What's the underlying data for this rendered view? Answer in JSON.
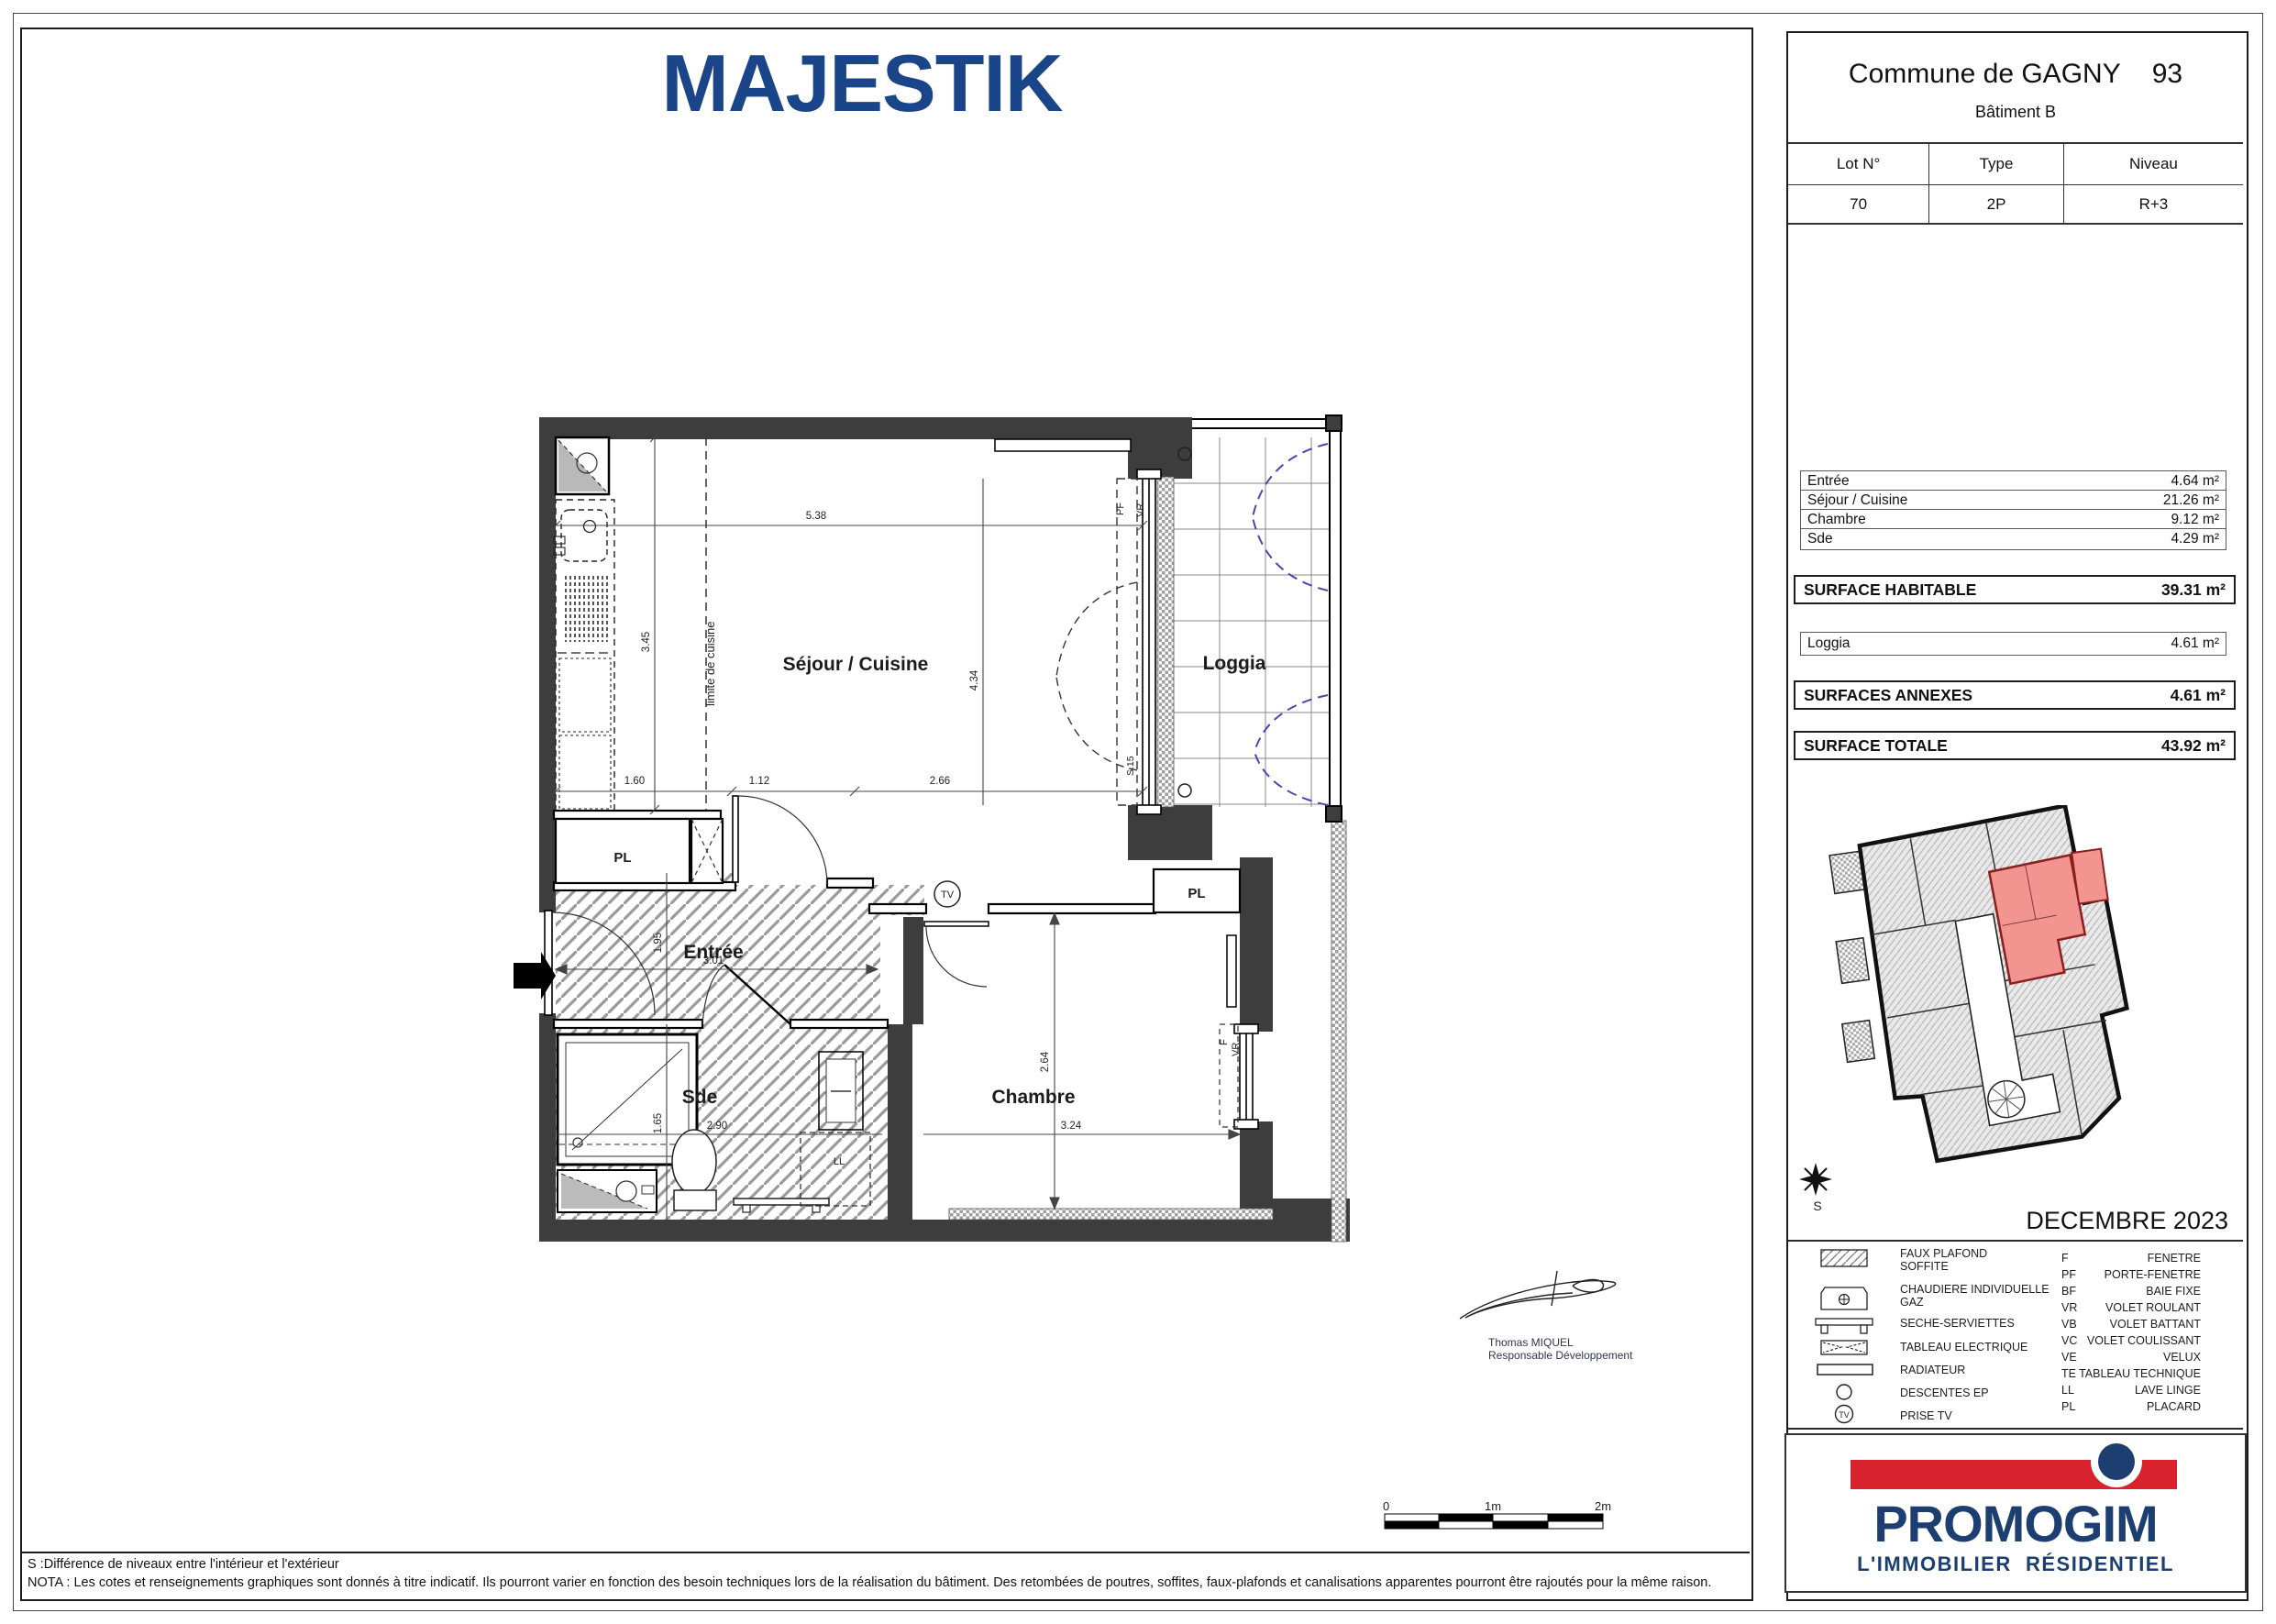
{
  "page": {
    "title": "MAJESTIK",
    "date": "DECEMBRE 2023"
  },
  "header": {
    "commune": "Commune de GAGNY",
    "departement": "93",
    "batiment": "Bâtiment B",
    "table": {
      "columns": [
        "Lot N°",
        "Type",
        "Niveau"
      ],
      "values": [
        "70",
        "2P",
        "R+3"
      ]
    }
  },
  "surfaces": {
    "rooms": [
      {
        "label": "Entrée",
        "area": "4.64 m²"
      },
      {
        "label": "Séjour / Cuisine",
        "area": "21.26 m²"
      },
      {
        "label": "Chambre",
        "area": "9.12 m²"
      },
      {
        "label": "Sde",
        "area": "4.29 m²"
      }
    ],
    "habitable": {
      "label": "SURFACE HABITABLE",
      "area": "39.31 m²"
    },
    "annexe_rooms": [
      {
        "label": "Loggia",
        "area": "4.61 m²"
      }
    ],
    "annexes": {
      "label": "SURFACES ANNEXES",
      "area": "4.61 m²"
    },
    "totale": {
      "label": "SURFACE TOTALE",
      "area": "43.92 m²"
    }
  },
  "plan": {
    "labels": {
      "sejour": "Séjour / Cuisine",
      "loggia": "Loggia",
      "entree": "Entrée",
      "sde": "Sde",
      "chambre": "Chambre",
      "pl": "PL",
      "limite": "limite de cuisine",
      "tv": "TV",
      "ll": "LL",
      "pf": "PF",
      "vr": "VR",
      "f": "F",
      "s15": "S.15"
    },
    "dims": {
      "d538": "5.38",
      "d345": "3.45",
      "d434": "4.34",
      "d160": "1.60",
      "d112": "1.12",
      "d266": "2.66",
      "d195": "1.95",
      "d301": "3.01",
      "d165": "1.65",
      "d290": "2.90",
      "d264": "2.64",
      "d324": "3.24"
    }
  },
  "scalebar": {
    "start": "0",
    "mid": "1m",
    "end": "2m"
  },
  "signature": {
    "name": "Thomas MIQUEL",
    "role": "Responsable Développement"
  },
  "compass": {
    "label": "S"
  },
  "legend": {
    "items": [
      {
        "line1": "FAUX PLAFOND",
        "line2": "SOFFITE"
      },
      {
        "line1": "CHAUDIERE INDIVIDUELLE",
        "line2": "GAZ"
      },
      {
        "line1": "SECHE-SERVIETTES"
      },
      {
        "line1": "TABLEAU ELECTRIQUE"
      },
      {
        "line1": "RADIATEUR"
      },
      {
        "line1": "DESCENTES EP"
      },
      {
        "line1": "PRISE TV"
      }
    ],
    "abbreviations": [
      {
        "code": "F",
        "label": "FENETRE"
      },
      {
        "code": "PF",
        "label": "PORTE-FENETRE"
      },
      {
        "code": "BF",
        "label": "BAIE FIXE"
      },
      {
        "code": "VR",
        "label": "VOLET ROULANT"
      },
      {
        "code": "VB",
        "label": "VOLET BATTANT"
      },
      {
        "code": "VC",
        "label": "VOLET COULISSANT"
      },
      {
        "code": "VE",
        "label": "VELUX"
      },
      {
        "code": "TE",
        "label": "TABLEAU TECHNIQUE"
      },
      {
        "code": "LL",
        "label": "LAVE LINGE"
      },
      {
        "code": "PL",
        "label": "PLACARD"
      }
    ]
  },
  "notes": {
    "s_note": "S :Différence de niveaux entre l'intérieur et l'extérieur",
    "nota": "NOTA : Les cotes et renseignements graphiques sont donnés à titre indicatif. Ils pourront varier en fonction des besoin techniques lors de la réalisation du bâtiment. Des retombées de poutres, soffites, faux-plafonds et canalisations apparentes pourront être rajoutés pour la même raison."
  },
  "brand": {
    "name": "PROMOGIM",
    "tagline": "L'IMMOBILIER  RÉSIDENTIEL"
  },
  "colors": {
    "accent_navy": "#1a4689",
    "brand_navy": "#1c3e70",
    "brand_red": "#d8232e",
    "unit_highlight": "#f29490",
    "wall_gray": "#3d3d3d",
    "arc_blue": "#4747b2"
  }
}
